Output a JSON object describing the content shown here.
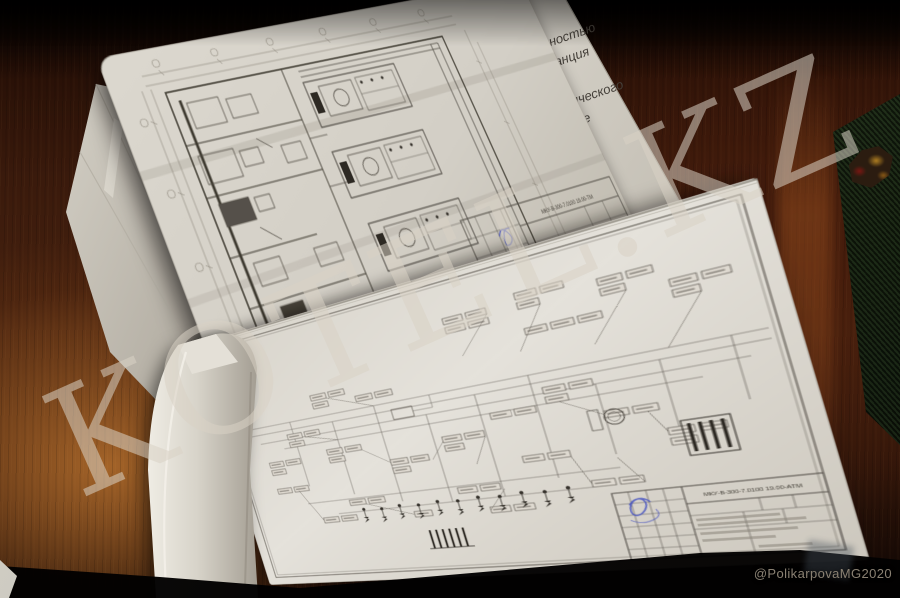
{
  "photo": {
    "watermark_text": "KOTEL.KZ",
    "credit": "@PolikarpovaMG2020"
  },
  "cover_page": {
    "line1": "щностью",
    "line2": "танция",
    "line3": "нического",
    "line4": "ние"
  },
  "top_sheet": {
    "title_code": "МКУ-В-300-7.0100 19.00-ТМ"
  },
  "bottom_sheet": {
    "title_code": "МКУ-В-300-7.0100 19.00-АТМ"
  },
  "colors": {
    "paper": "#ddd9d0",
    "ink": "#4f4a43",
    "stamp_blue": "#4753c1",
    "wood": "#3a1a0c",
    "folder_green": "#1b271d"
  }
}
